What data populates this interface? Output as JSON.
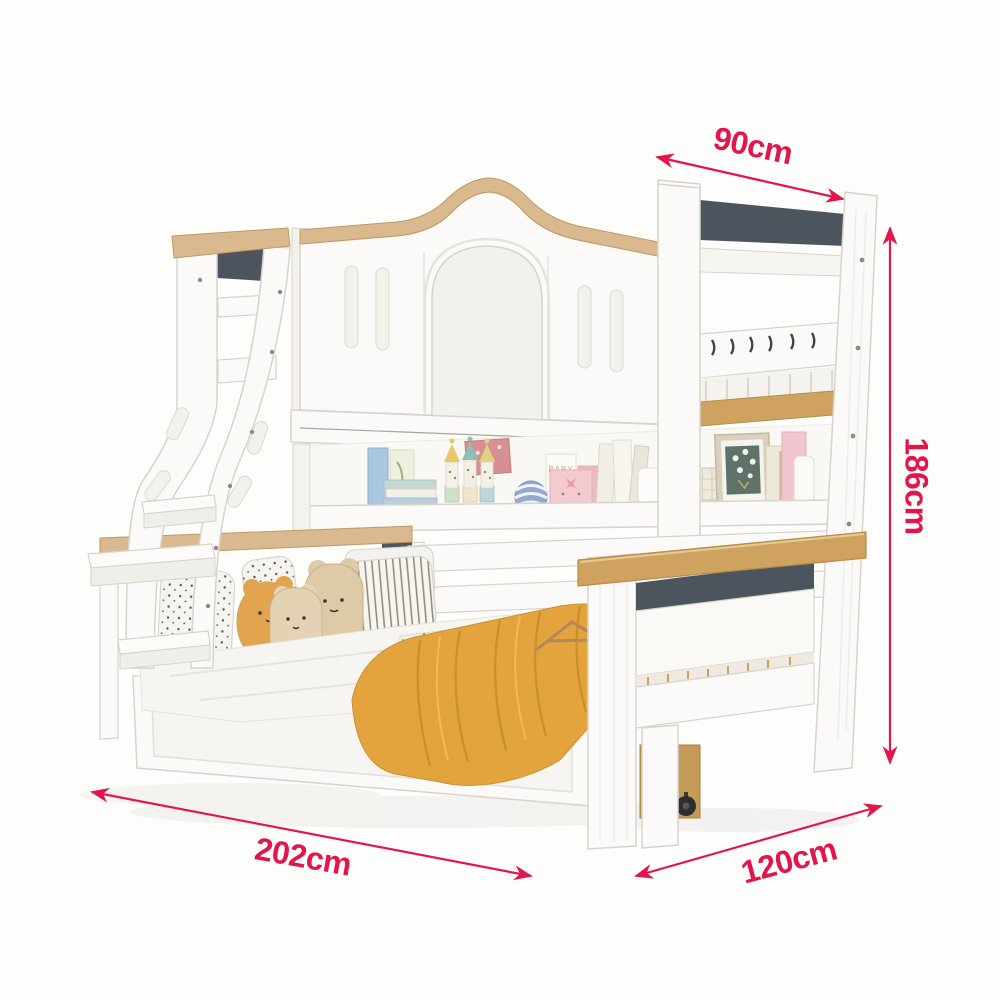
{
  "alt": "White kids bunk bed with arched upper guard panel, curved ladder, mid bookshelf, lower bed with pillows and yellow blanket, trundle drawer; annotated with product dimensions",
  "theme": {
    "bg": "#fdfdfc",
    "accent": "#e2164a",
    "wood": "#d9b98d",
    "wood-deep": "#cfa25f",
    "wood-drawer": "#c49a58",
    "slate": "#4c545d",
    "panel": "#fbfaf8",
    "panel-dim": "#f3f1ec",
    "outline": "#d8d4cc",
    "blanket": "#e3a43e",
    "blanket-fold": "#c98f2b",
    "plush": "#dfcaa8",
    "plush-yellow": "#e2a44e"
  },
  "annotations": {
    "color": "#e2164a",
    "top_width": {
      "text": "90cm"
    },
    "height": {
      "text": "186cm"
    },
    "length": {
      "text": "202cm"
    },
    "bottom_width": {
      "text": "120cm"
    }
  },
  "decor": {
    "baby_box_text": "BABY",
    "pillow_text": "MAISON"
  }
}
